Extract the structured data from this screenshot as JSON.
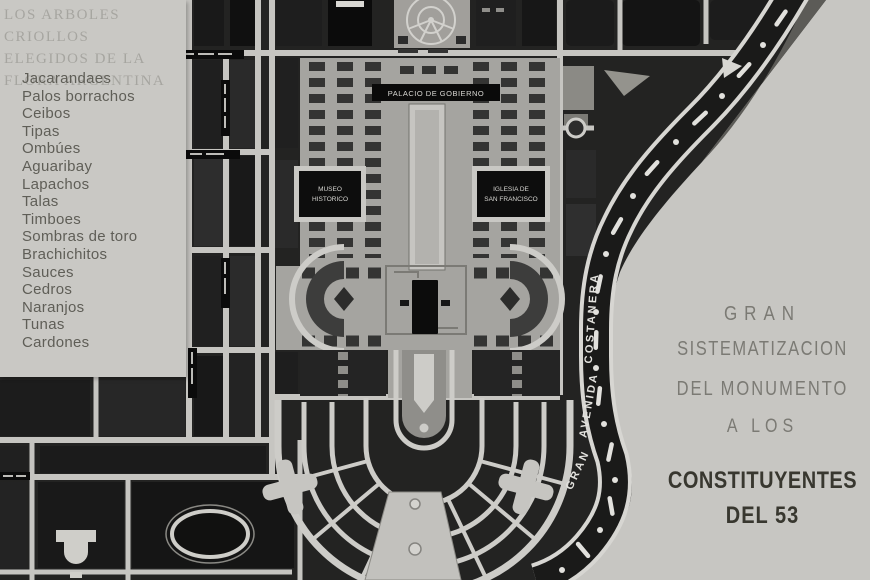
{
  "panel": {
    "title_lines": [
      "LOS ARBOLES CRIOLLOS",
      "ELEGIDOS DE LA",
      "FLORA ARGENTINA"
    ],
    "trees": [
      "Jacarandaes",
      "Palos borrachos",
      "Ceibos",
      "Tipas",
      "Ombúes",
      "Aguaribay",
      "Lapachos",
      "Talas",
      "Timboes",
      "Sombras de toro",
      "Brachichitos",
      "Sauces",
      "Cedros",
      "Naranjos",
      "Tunas",
      "Cardones"
    ]
  },
  "map": {
    "labels": {
      "palacio": "PALACIO DE GOBIERNO",
      "museo_line1": "MUSEO",
      "museo_line2": "HISTORICO",
      "iglesia_line1": "IGLESIA DE",
      "iglesia_line2": "SAN FRANCISCO",
      "avenida_gran": "GRAN",
      "avenida_avenida": "AVENIDA",
      "avenida_costanera": "COSTANERA"
    }
  },
  "caption": {
    "line1": "GRAN",
    "line2": "SISTEMATIZACION",
    "line3": "DEL MONUMENTO",
    "line4": "A LOS",
    "line5": "CONSTITUYENTES",
    "line6": "DEL 53"
  },
  "colors": {
    "paper": "#c7c6c2",
    "map_ink": "#232322",
    "street_light": "#c6c5c1",
    "road_dark": "#1a1a19"
  }
}
